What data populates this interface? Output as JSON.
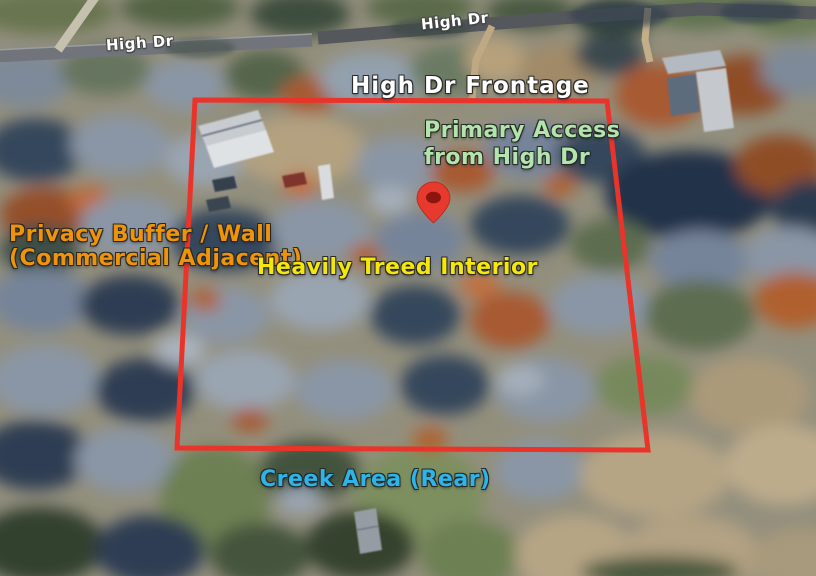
{
  "map": {
    "road_labels": {
      "left": "High Dr",
      "right": "High Dr"
    },
    "annotations": {
      "frontage": {
        "text": "High Dr Frontage",
        "color": "#ffffff"
      },
      "primary_access": {
        "line1": "Primary Access",
        "line2": "from High Dr",
        "color": "#b2e5ac"
      },
      "privacy_buffer": {
        "line1": "Privacy Buffer / Wall",
        "line2": "(Commercial Adjacent)",
        "color": "#ef9309"
      },
      "treed_interior": {
        "text": "Heavily Treed Interior",
        "color": "#f3e70b"
      },
      "creek_area": {
        "text": "Creek Area (Rear)",
        "color": "#2db4e8"
      }
    },
    "boundary": {
      "color": "#e8342b"
    },
    "pin": {
      "color": "#e63a2e",
      "inner_color": "#8c150e"
    }
  }
}
